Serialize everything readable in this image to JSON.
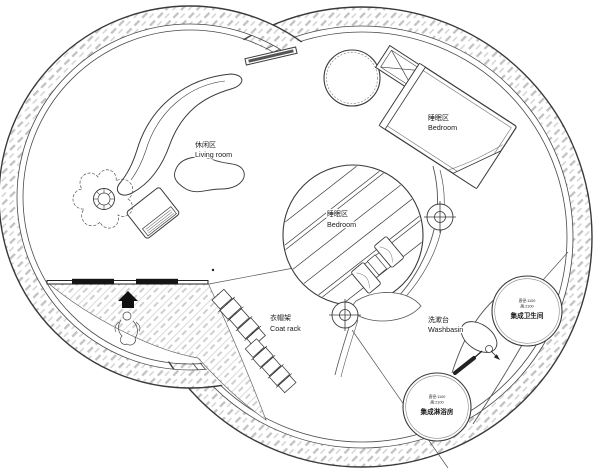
{
  "colors": {
    "background": "#ffffff",
    "line": "#3a3a3a",
    "hatch_dash": "#c2c2c2",
    "deck_dash": "#cccccc",
    "lintel_black": "#151515"
  },
  "areas": {
    "living_room": {
      "label_zh": "休闲区",
      "label_en": "Living room"
    },
    "bedroom_upper": {
      "label_zh": "睡眠区",
      "label_en": "Bedroom"
    },
    "bedroom_center": {
      "label_zh": "睡眠区",
      "label_en": "Bedroom"
    },
    "coat_rack": {
      "label_zh": "衣帽架",
      "label_en": "Coat rack"
    },
    "washbasin": {
      "label_zh": "洗漱台",
      "label_en": "Washbasin"
    },
    "toilet_pod": {
      "spec_line1": "直径:1100",
      "spec_line2": "高:2100",
      "label_zh": "集成卫生间"
    },
    "shower_pod": {
      "spec_line1": "直径:1100",
      "spec_line2": "高:2100",
      "label_zh": "集成淋浴房"
    }
  },
  "icons": [
    "plant-icon",
    "sofa-icon",
    "coffee-table-icon",
    "armchair-icon",
    "tv-board-icon",
    "round-table-icon",
    "bed-icon",
    "ac-unit-icon",
    "circular-bed-icon",
    "pillow-icon",
    "target-symbol-icon",
    "coat-rack-icon",
    "washbasin-icon",
    "faucet-icon",
    "pen-arrow-icon",
    "toilet-pod-icon",
    "shower-pod-icon",
    "entrance-arrow-icon",
    "person-figure-icon"
  ]
}
